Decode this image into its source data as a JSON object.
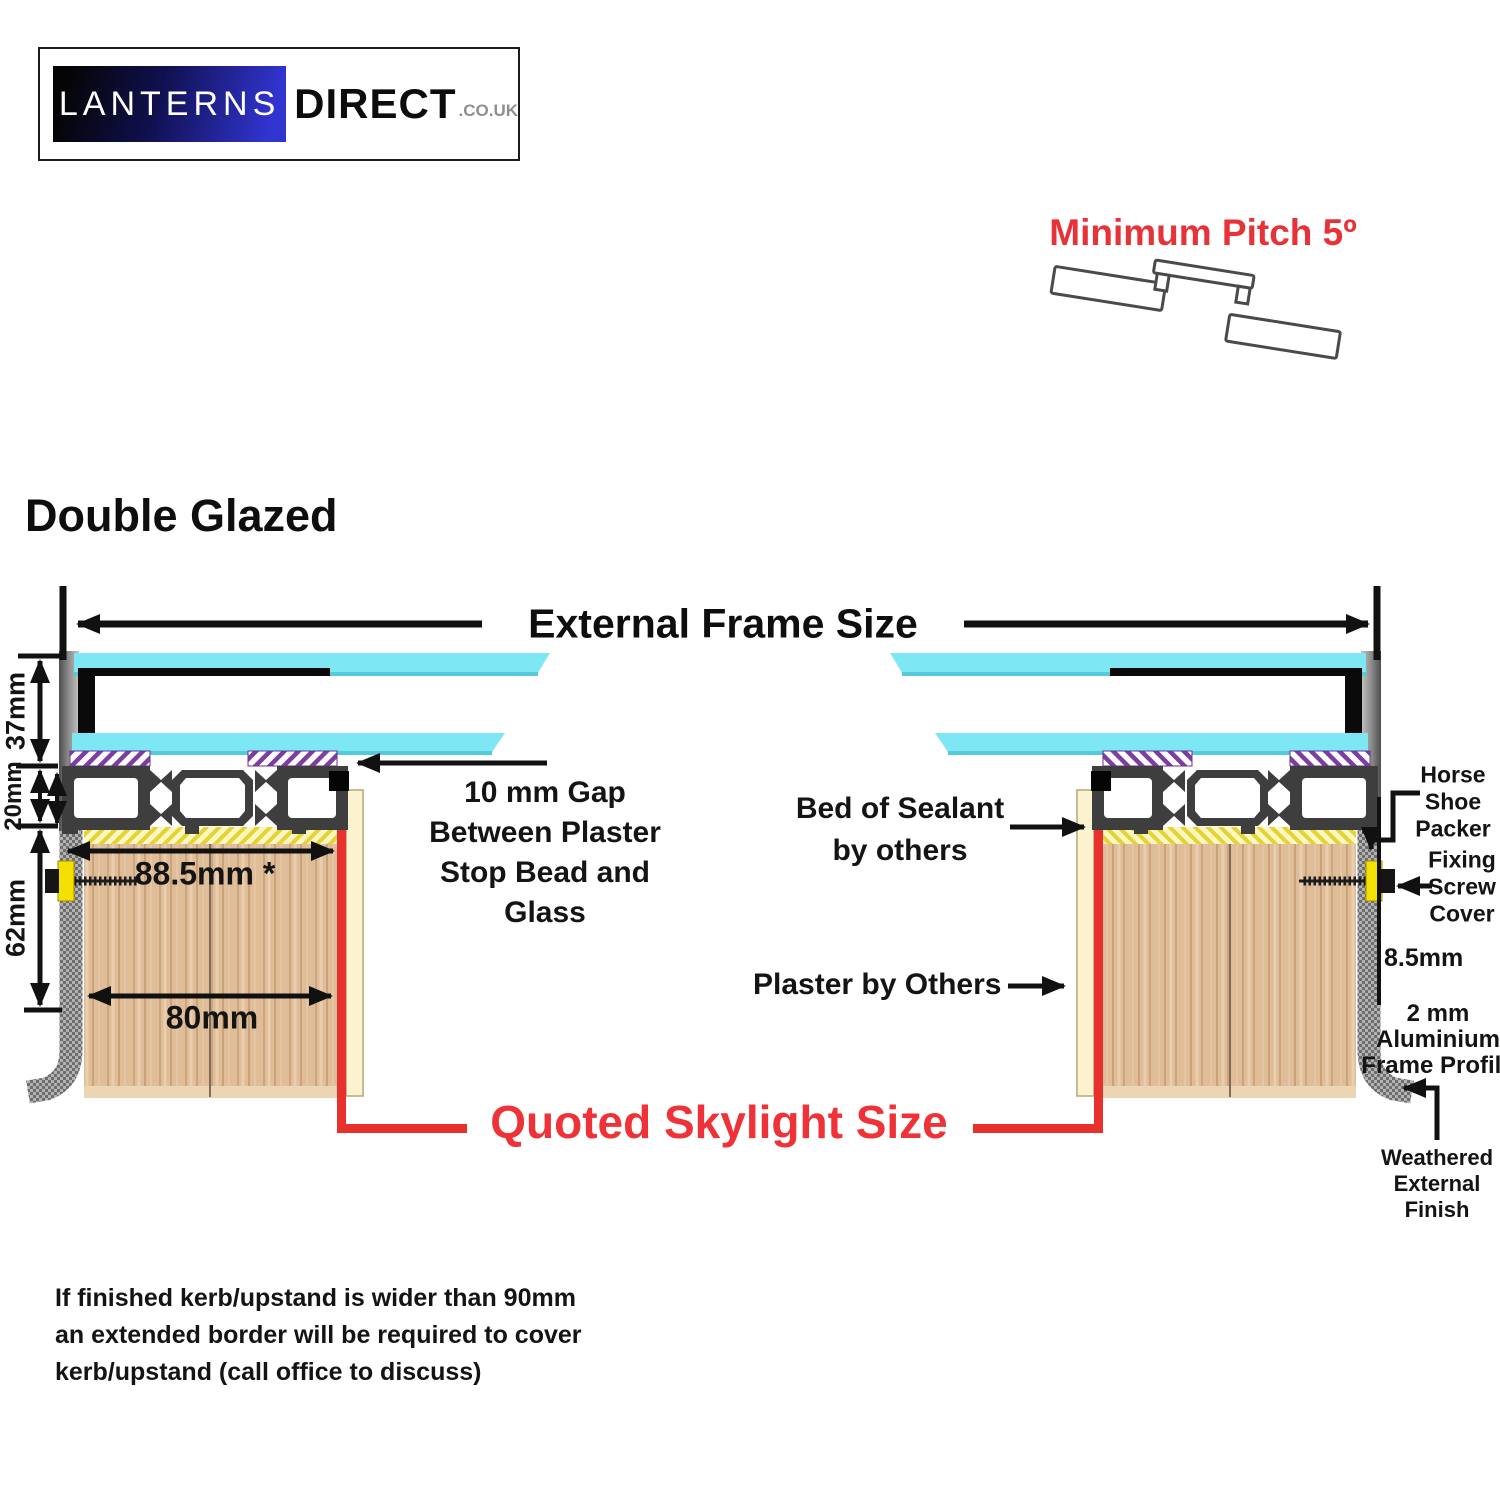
{
  "logo": {
    "brand_primary": "LANTERNS",
    "brand_secondary": "DIRECT",
    "brand_tld": ".CO.UK"
  },
  "pitch": {
    "label": "Minimum Pitch 5º"
  },
  "section": {
    "heading": "Double Glazed"
  },
  "frame": {
    "external_label": "External Frame Size"
  },
  "dims": {
    "glazing_height": "37mm",
    "profile_height": "20mm",
    "frame_drop": "62mm",
    "border_width": "88.5mm *",
    "kerb_cover": "80mm",
    "edge_gap": "8.5mm"
  },
  "labels": {
    "gap_note": "10 mm Gap\nBetween Plaster\nStop Bead and\nGlass",
    "sealant": "Bed of Sealant\nby others",
    "plaster": "Plaster by Others",
    "packer": "Horse\nShoe\nPacker",
    "screw_cover": "Fixing\nScrew\nCover",
    "alu_profile": "2 mm\nAluminium\nFrame Profile",
    "weathered": "Weathered\nExternal\nFinish",
    "quoted": "Quoted Skylight Size"
  },
  "footnote": "If finished kerb/upstand is wider than 90mm\nan extended border will be required to cover\nkerb/upstand (call office to discuss)",
  "colors": {
    "accent_red": "#e73338",
    "quoted_red": "#ee3237",
    "glass_cyan": "#7ee7f4",
    "wood_tan": "#dfbd99",
    "sealant_yellow": "#e6d234",
    "tape_purple": "#7d3f9f",
    "frame_grey": "#3e3e3e"
  }
}
